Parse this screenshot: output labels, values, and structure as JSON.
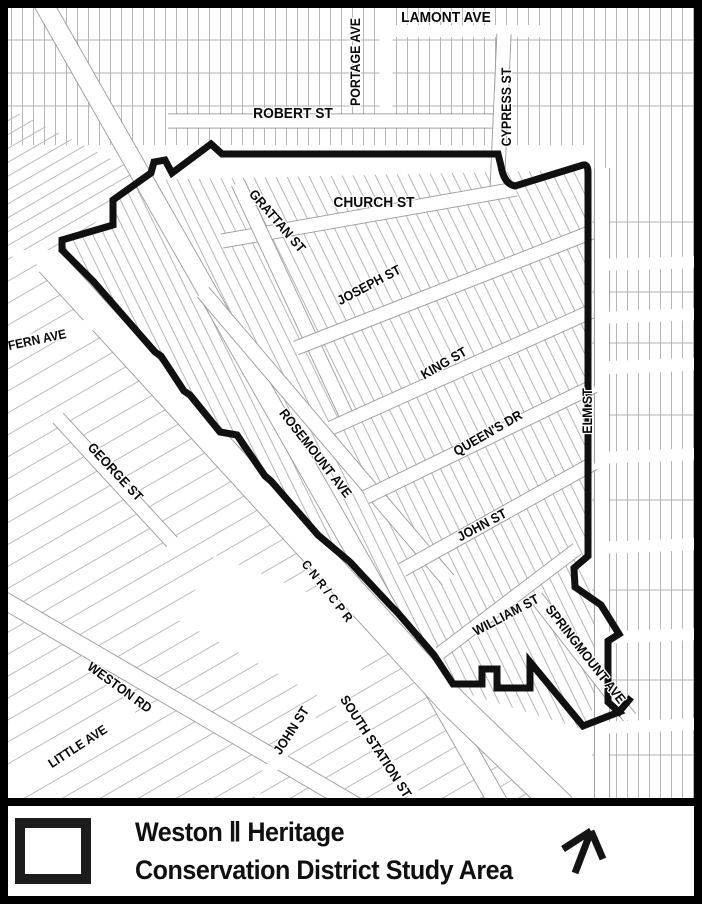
{
  "map": {
    "kind": "heritage-district-street-map",
    "labels": [
      {
        "id": "lamont-ave",
        "text": "LAMONT AVE",
        "x": 446,
        "y": 22,
        "rot": 0,
        "size": 15
      },
      {
        "id": "portage-ave",
        "text": "PORTAGE AVE",
        "x": 360,
        "y": 62,
        "rot": -90,
        "size": 13.5
      },
      {
        "id": "robert-st",
        "text": "ROBERT ST",
        "x": 293,
        "y": 118,
        "rot": 0,
        "size": 15
      },
      {
        "id": "cypress-st",
        "text": "CYPRESS ST",
        "x": 511,
        "y": 107,
        "rot": -90,
        "size": 13.5
      },
      {
        "id": "church-st",
        "text": "CHURCH ST",
        "x": 374,
        "y": 207,
        "rot": 0,
        "size": 15
      },
      {
        "id": "grattan-st",
        "text": "GRATTAN ST",
        "x": 274,
        "y": 224,
        "rot": 49,
        "size": 13.5
      },
      {
        "id": "joseph-st",
        "text": "JOSEPH ST",
        "x": 371,
        "y": 289,
        "rot": -28,
        "size": 13.5
      },
      {
        "id": "fern-ave",
        "text": "FERN AVE",
        "x": 38,
        "y": 344,
        "rot": -12,
        "size": 13
      },
      {
        "id": "king-st",
        "text": "KING ST",
        "x": 446,
        "y": 367,
        "rot": -30,
        "size": 13.5
      },
      {
        "id": "elm-st",
        "text": "ELM ST",
        "x": 592,
        "y": 411,
        "rot": -90,
        "size": 13.5
      },
      {
        "id": "rosemount-ave",
        "text": "ROSEMOUNT AVE",
        "x": 312,
        "y": 456,
        "rot": 52,
        "size": 13.5
      },
      {
        "id": "queens-dr",
        "text": "QUEEN'S DR",
        "x": 490,
        "y": 437,
        "rot": -30,
        "size": 13.5
      },
      {
        "id": "george-st",
        "text": "GEORGE ST",
        "x": 112,
        "y": 475,
        "rot": 47,
        "size": 13.5
      },
      {
        "id": "john-st",
        "text": "JOHN ST",
        "x": 484,
        "y": 529,
        "rot": -28,
        "size": 13.5
      },
      {
        "id": "cnr-cpr",
        "text": "CNR/CPR",
        "x": 325,
        "y": 595,
        "rot": 52,
        "size": 12.5,
        "spacing": 4
      },
      {
        "id": "william-st",
        "text": "WILLIAM ST",
        "x": 508,
        "y": 619,
        "rot": -28,
        "size": 13.5
      },
      {
        "id": "springmount-ave",
        "text": "SPRINGMOUNT AVE",
        "x": 582,
        "y": 657,
        "rot": 52,
        "size": 13.5
      },
      {
        "id": "weston-rd",
        "text": "WESTON RD",
        "x": 117,
        "y": 691,
        "rot": 36,
        "size": 13.5
      },
      {
        "id": "little-ave",
        "text": "LITTLE AVE",
        "x": 80,
        "y": 750,
        "rot": -33,
        "size": 13
      },
      {
        "id": "john-st-south",
        "text": "JOHN ST",
        "x": 295,
        "y": 733,
        "rot": -57,
        "size": 13.5
      },
      {
        "id": "south-station-st",
        "text": "SOUTH STATION ST",
        "x": 372,
        "y": 749,
        "rot": 57,
        "size": 13.5
      }
    ]
  },
  "legend": {
    "line1": "Weston Ⅱ Heritage",
    "line2": "Conservation District Study Area",
    "symbol": "study-area-boundary-swatch",
    "north_arrow": "north-arrow"
  },
  "colors": {
    "background": "#ffffff",
    "frame": "#000000",
    "boundary": "#101010",
    "parcel_line": "#b3b3b3",
    "street_edge": "#a0a0a0",
    "label_text": "#0a0a0a"
  }
}
